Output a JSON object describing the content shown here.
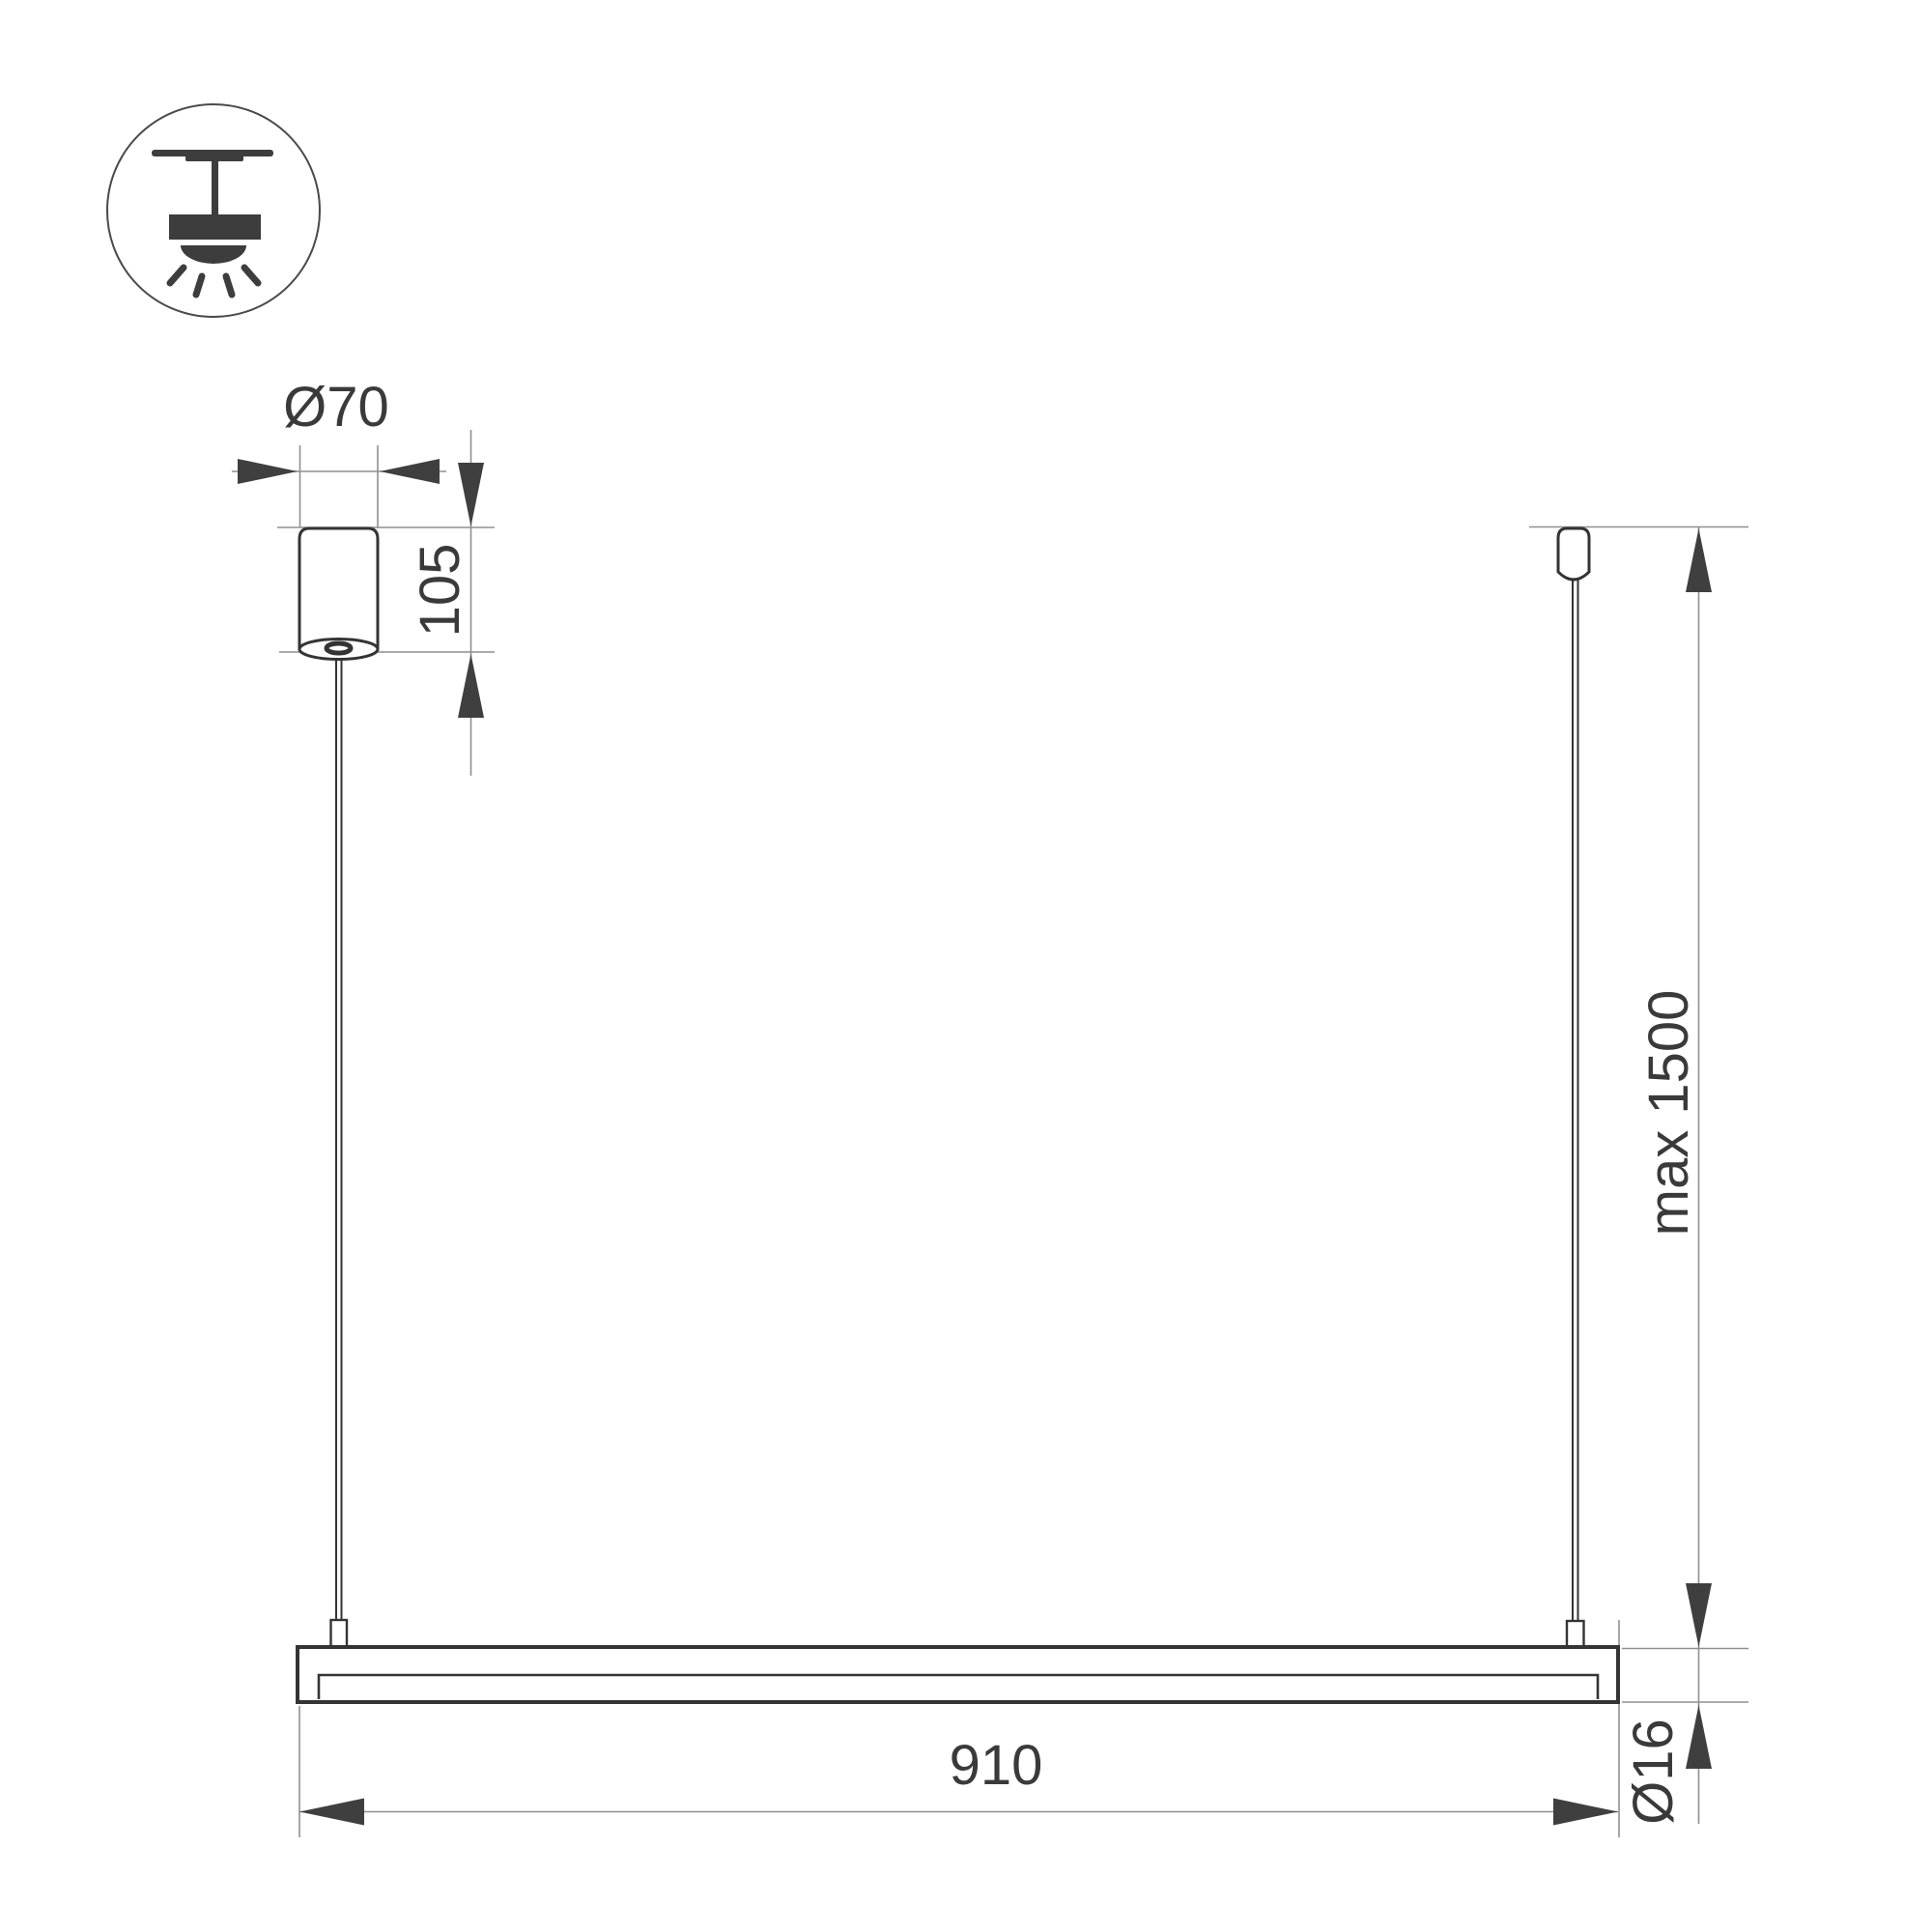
{
  "dimensions": {
    "canopy_diameter": "Ø70",
    "canopy_height": "105",
    "bar_length": "910",
    "max_suspension_height": "max 1500",
    "bar_diameter": "Ø16"
  },
  "icon": {
    "name": "pendant-ceiling-light-icon"
  },
  "colors": {
    "outline": "#343434",
    "dimension_line": "#8f8f8f",
    "arrow_fill": "#3f3f3f",
    "text": "#3a3a3a",
    "background": "#ffffff"
  }
}
